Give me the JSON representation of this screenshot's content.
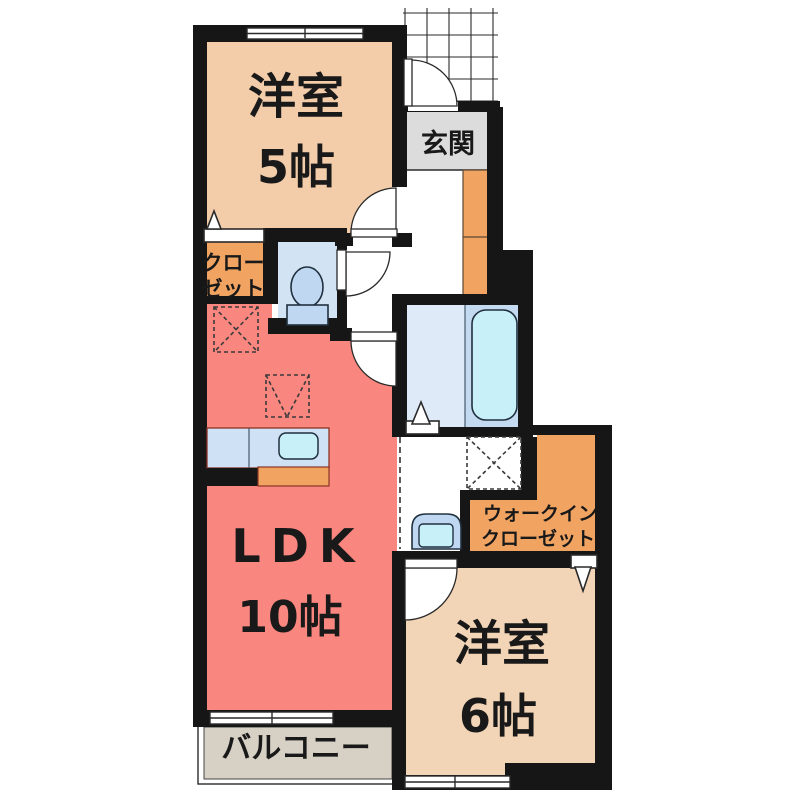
{
  "plan": {
    "rooms": {
      "western5": {
        "label": "洋室",
        "size": "5帖"
      },
      "entrance": {
        "label": "玄関"
      },
      "closet": {
        "label_line1": "クロー",
        "label_line2": "ゼット"
      },
      "ldk": {
        "label": "LDK",
        "size": "10帖"
      },
      "wic": {
        "label_line1": "ウォークイン",
        "label_line2": "クローゼット"
      },
      "western6": {
        "label": "洋室",
        "size": "6帖"
      },
      "balcony": {
        "label": "バルコニー"
      }
    },
    "colors": {
      "wall": "#161616",
      "western5": "#f3cca9",
      "western6": "#f2d5b6",
      "ldk": "#f9867f",
      "storage_orange": "#f1a462",
      "entrance_gray": "#dcdcdc",
      "balcony_gray": "#d7d0c5",
      "wet_blue": "#d2e3f4",
      "bath_left": "#dfeaf8",
      "bath_right": "#c4daf1",
      "tub_cyan": "#c8f0f8",
      "fixture_blue": "#bfd7f0"
    }
  }
}
